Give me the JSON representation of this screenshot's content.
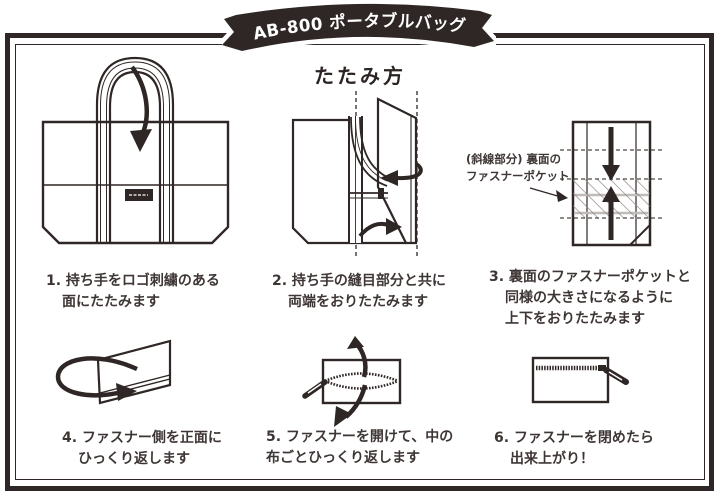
{
  "colors": {
    "ink": "#2f2725",
    "text": "#3e3634",
    "bg": "#ffffff"
  },
  "banner": {
    "title": "AB-800 ポータブルバッグ"
  },
  "heading": {
    "title": "たたみ方"
  },
  "annotation": {
    "lines": [
      "(斜線部分) 裏面の",
      "ファスナーポケット"
    ]
  },
  "steps": [
    {
      "lines": [
        "1. 持ち手をロゴ刺繍のある",
        "面にたたみます"
      ]
    },
    {
      "lines": [
        "2. 持ち手の縫目部分と共に",
        "両端をおりたたみます"
      ]
    },
    {
      "lines": [
        "3. 裏面のファスナーポケットと",
        "同様の大きさになるように",
        "上下をおりたたみます"
      ]
    },
    {
      "lines": [
        "4. ファスナー側を正面に",
        "ひっくり返します"
      ]
    },
    {
      "lines": [
        "5. ファスナーを開けて、中の",
        "布ごとひっくり返します"
      ]
    },
    {
      "lines": [
        "6. ファスナーを閉めたら",
        "出来上がり！"
      ]
    }
  ]
}
